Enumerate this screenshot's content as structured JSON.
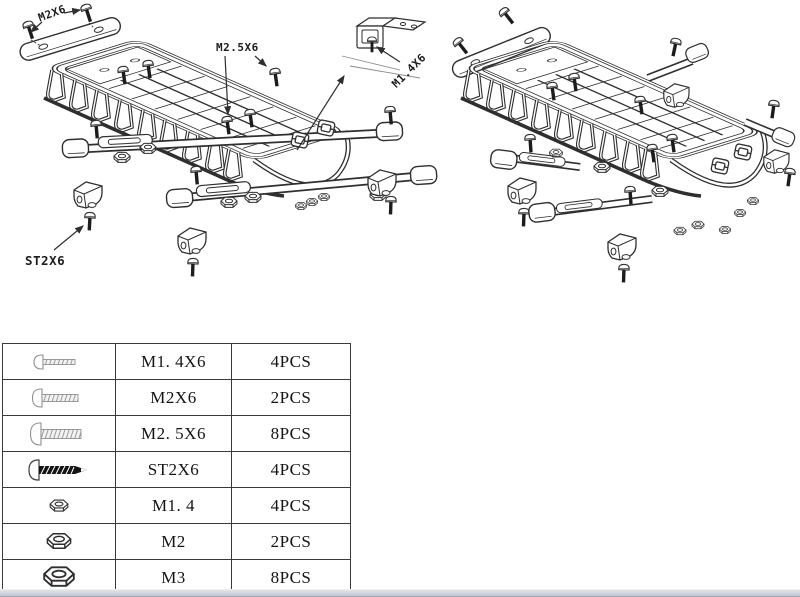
{
  "colors": {
    "line": "#2f2f2f",
    "background": "#ffffff",
    "scrollbar": "#c7cad5"
  },
  "diagram": {
    "left": {
      "name": "exploded-roof-rack-with-callouts",
      "labels": {
        "m2x6": "M2X6",
        "m2_5x6": "M2.5X6",
        "m1_4x6": "M1.4X6",
        "st2x6": "ST2X6"
      }
    },
    "right": {
      "name": "exploded-roof-rack-alternate-view"
    }
  },
  "parts_table": {
    "rows": [
      {
        "icon": "machine-screw-small-icon",
        "size": "M1. 4X6",
        "qty": "4PCS"
      },
      {
        "icon": "machine-screw-medium-icon",
        "size": "M2X6",
        "qty": "2PCS"
      },
      {
        "icon": "machine-screw-large-icon",
        "size": "M2. 5X6",
        "qty": "8PCS"
      },
      {
        "icon": "self-tapping-screw-icon",
        "size": "ST2X6",
        "qty": "4PCS"
      },
      {
        "icon": "hex-nut-small-icon",
        "size": "M1. 4",
        "qty": "4PCS"
      },
      {
        "icon": "hex-nut-medium-icon",
        "size": "M2",
        "qty": "2PCS"
      },
      {
        "icon": "hex-nut-large-icon",
        "size": "M3",
        "qty": "8PCS"
      }
    ]
  }
}
